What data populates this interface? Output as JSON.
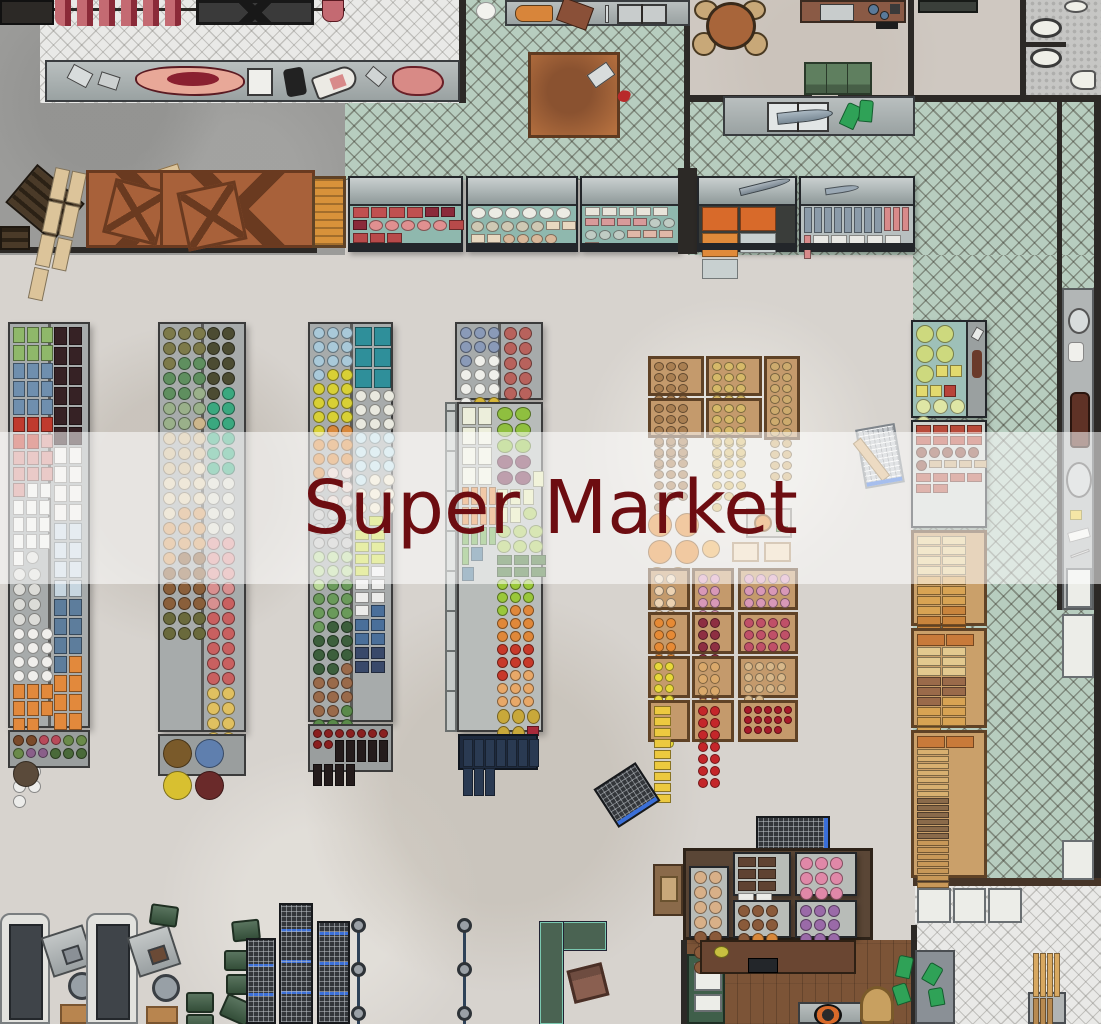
{
  "banner": {
    "title": "Super Market",
    "text_color": "#6d0d11",
    "overlay_color": "rgba(255,255,255,0.55)"
  },
  "palette": {
    "floor_main": "#d7d3ce",
    "floor_storage": "#9b9b99",
    "tile_green": "#b7cdbf",
    "tile_white": "#e9e9e7",
    "floor_breakroom": "#cfc8c1",
    "floor_bathroom": "#c6c6c4",
    "wood_floor": "#7c5437",
    "wall": "#2c2926",
    "case_interior": "#8fb8ae",
    "counter_steel": "#a8b0b0",
    "crate_wood": "#c49a6c",
    "cart_blue": "#3a6fd8",
    "service_counter_green": "#4a6352",
    "service_counter_trim": "#7ac8b0"
  },
  "fills": {
    "a1_left": [
      {
        "c": "#8fb86a",
        "n": 6,
        "s": "b",
        "w": 10,
        "h": 14
      },
      {
        "c": "#6f8fae",
        "n": 9,
        "s": "b",
        "w": 10,
        "h": 14
      },
      {
        "c": "#c03a2e",
        "n": 5,
        "s": "b",
        "w": 10,
        "h": 13
      },
      {
        "c": "#d08a86",
        "n": 8,
        "s": "b",
        "w": 10,
        "h": 12
      },
      {
        "c": "#eceae6",
        "n": 12,
        "s": "b",
        "w": 9,
        "h": 13
      },
      {
        "c": "#dcdcd8",
        "n": 9,
        "s": "r",
        "w": 11,
        "h": 11
      },
      {
        "c": "#f0efec",
        "n": 12,
        "s": "r",
        "w": 10,
        "h": 10
      },
      {
        "c": "#e2893c",
        "n": 8,
        "s": "b",
        "w": 10,
        "h": 13
      },
      {
        "c": "#ececea",
        "n": 9,
        "s": "r",
        "w": 11,
        "h": 11
      }
    ],
    "a1_right": [
      {
        "c": "#362225",
        "n": 12,
        "s": "b",
        "w": 11,
        "h": 16
      },
      {
        "c": "#ece9e4",
        "n": 8,
        "s": "b",
        "w": 11,
        "h": 15
      },
      {
        "c": "#c7d6e0",
        "n": 8,
        "s": "b",
        "w": 11,
        "h": 15
      },
      {
        "c": "#5d7d9c",
        "n": 7,
        "s": "b",
        "w": 11,
        "h": 15
      },
      {
        "c": "#e2893c",
        "n": 10,
        "s": "b",
        "w": 11,
        "h": 15
      }
    ],
    "a1_bottom": [
      {
        "c": "#7a4a2a",
        "n": 2,
        "s": "r",
        "w": 9,
        "h": 9
      },
      {
        "c": "#b84a5a",
        "n": 2,
        "s": "r",
        "w": 8,
        "h": 8
      },
      {
        "c": "#6a8a4a",
        "n": 3,
        "s": "r",
        "w": 9,
        "h": 9
      },
      {
        "c": "#8a5f8a",
        "n": 2,
        "s": "r",
        "w": 8,
        "h": 8
      },
      {
        "c": "#4a6a3a",
        "n": 3,
        "s": "r",
        "w": 9,
        "h": 9
      },
      {
        "c": "#5a4a3a",
        "n": 1,
        "s": "r",
        "w": 24,
        "h": 24
      }
    ],
    "a2_left": [
      {
        "c": "#7d7a4a",
        "n": 7,
        "s": "r",
        "w": 11,
        "h": 11
      },
      {
        "c": "#5f8f5f",
        "n": 7,
        "s": "r",
        "w": 11,
        "h": 11
      },
      {
        "c": "#9ab08a",
        "n": 6,
        "s": "r",
        "w": 11,
        "h": 11
      },
      {
        "c": "#cdb68c",
        "n": 9,
        "s": "r",
        "w": 11,
        "h": 11
      },
      {
        "c": "#dcccaa",
        "n": 8,
        "s": "r",
        "w": 11,
        "h": 11
      },
      {
        "c": "#d09a60",
        "n": 9,
        "s": "r",
        "w": 11,
        "h": 11
      },
      {
        "c": "#8a5f3a",
        "n": 11,
        "s": "r",
        "w": 11,
        "h": 11
      },
      {
        "c": "#6a6a3c",
        "n": 6,
        "s": "r",
        "w": 11,
        "h": 11
      }
    ],
    "a2_right": [
      {
        "c": "#4c4c32",
        "n": 9,
        "s": "r",
        "w": 11,
        "h": 11
      },
      {
        "c": "#3aa87f",
        "n": 11,
        "s": "r",
        "w": 11,
        "h": 11
      },
      {
        "c": "#d8d8cb",
        "n": 8,
        "s": "r",
        "w": 11,
        "h": 11
      },
      {
        "c": "#d89090",
        "n": 9,
        "s": "r",
        "w": 11,
        "h": 11
      },
      {
        "c": "#c96060",
        "n": 11,
        "s": "r",
        "w": 11,
        "h": 11
      },
      {
        "c": "#e0c060",
        "n": 11,
        "s": "r",
        "w": 11,
        "h": 11
      }
    ],
    "a2_baskets": [
      {
        "c": "#7a5a2a",
        "n": 1,
        "s": "r",
        "w": 27,
        "h": 27
      },
      {
        "c": "#5f7fae",
        "n": 1,
        "s": "r",
        "w": 27,
        "h": 27
      },
      {
        "c": "#d8c030",
        "n": 1,
        "s": "r",
        "w": 27,
        "h": 27
      },
      {
        "c": "#6a2a2a",
        "n": 1,
        "s": "r",
        "w": 27,
        "h": 27
      }
    ],
    "a3_left": [
      {
        "c": "#a9c9d9",
        "n": 10,
        "s": "r",
        "w": 10,
        "h": 10
      },
      {
        "c": "#d8d035",
        "n": 12,
        "s": "r",
        "w": 10,
        "h": 10
      },
      {
        "c": "#d8883a",
        "n": 9,
        "s": "r",
        "w": 10,
        "h": 10
      },
      {
        "c": "#e2ccc4",
        "n": 8,
        "s": "r",
        "w": 10,
        "h": 10
      },
      {
        "c": "#c2c2be",
        "n": 9,
        "s": "r",
        "w": 10,
        "h": 10
      },
      {
        "c": "#b8d898",
        "n": 7,
        "s": "r",
        "w": 10,
        "h": 10
      },
      {
        "c": "#6a9a5a",
        "n": 9,
        "s": "r",
        "w": 10,
        "h": 10
      },
      {
        "c": "#3c5f3c",
        "n": 10,
        "s": "r",
        "w": 10,
        "h": 10
      },
      {
        "c": "#9a6a4a",
        "n": 9,
        "s": "r",
        "w": 10,
        "h": 10
      },
      {
        "c": "#5a8a4a",
        "n": 7,
        "s": "r",
        "w": 10,
        "h": 10
      }
    ],
    "a3_right": [
      {
        "c": "#2f8f9a",
        "n": 6,
        "s": "b",
        "w": 15,
        "h": 17
      },
      {
        "c": "#e9e9df",
        "n": 9,
        "s": "r",
        "w": 10,
        "h": 10
      },
      {
        "c": "#bcdce4",
        "n": 10,
        "s": "r",
        "w": 10,
        "h": 10
      },
      {
        "c": "#eae2ca",
        "n": 9,
        "s": "r",
        "w": 10,
        "h": 10
      },
      {
        "c": "#c9d93c",
        "n": 8,
        "s": "b",
        "w": 12,
        "h": 8
      },
      {
        "c": "#ececea",
        "n": 6,
        "s": "b",
        "w": 12,
        "h": 9
      },
      {
        "c": "#4a6f9a",
        "n": 5,
        "s": "b",
        "w": 12,
        "h": 10
      },
      {
        "c": "#39496a",
        "n": 4,
        "s": "b",
        "w": 12,
        "h": 10
      }
    ],
    "a3_bottles": [
      {
        "c": "#8a1f1f",
        "n": 9,
        "s": "r",
        "w": 7,
        "h": 7
      },
      {
        "c": "#241c1c",
        "n": 9,
        "s": "b",
        "w": 7,
        "h": 20
      }
    ],
    "a4_cans": [
      {
        "c": "#8a9ab8",
        "n": 7,
        "s": "r",
        "w": 10,
        "h": 10
      },
      {
        "c": "#efefea",
        "n": 9,
        "s": "r",
        "w": 10,
        "h": 10
      },
      {
        "c": "#d8b83a",
        "n": 7,
        "s": "r",
        "w": 10,
        "h": 10
      },
      {
        "c": "#efefea",
        "n": 7,
        "s": "r",
        "w": 10,
        "h": 10
      },
      {
        "c": "#b84a3a",
        "n": 8,
        "s": "r",
        "w": 10,
        "h": 10
      }
    ],
    "a4_cans_right": [
      {
        "c": "#b8625c",
        "n": 14,
        "s": "r",
        "w": 11,
        "h": 11
      }
    ],
    "a4_packs": [
      {
        "c": "#eceedb",
        "n": 8,
        "s": "b",
        "w": 12,
        "h": 16
      },
      {
        "c": "#e0853a",
        "n": 8,
        "s": "b",
        "w": 5,
        "h": 16
      },
      {
        "c": "#6aa84a",
        "n": 5,
        "s": "b",
        "w": 5,
        "h": 16
      },
      {
        "c": "#3a6a8a",
        "n": 2,
        "s": "b",
        "w": 10,
        "h": 12
      }
    ],
    "a4_veg": [
      {
        "c": "#8fbf3f",
        "n": 6,
        "s": "r",
        "w": 14,
        "h": 12
      },
      {
        "c": "#6f2a4a",
        "n": 4,
        "s": "r",
        "w": 14,
        "h": 12
      },
      {
        "c": "#dfe4ad",
        "n": 6,
        "s": "b",
        "w": 9,
        "h": 14
      },
      {
        "c": "#a8c85a",
        "n": 7,
        "s": "r",
        "w": 12,
        "h": 11
      },
      {
        "c": "#3a6a2a",
        "n": 6,
        "s": "b",
        "w": 13,
        "h": 8
      },
      {
        "c": "#9ac83a",
        "n": 7,
        "s": "r",
        "w": 9,
        "h": 9
      },
      {
        "c": "#e0883a",
        "n": 8,
        "s": "r",
        "w": 9,
        "h": 9
      },
      {
        "c": "#c8392a",
        "n": 7,
        "s": "r",
        "w": 9,
        "h": 9
      },
      {
        "c": "#e8a868",
        "n": 8,
        "s": "r",
        "w": 9,
        "h": 9
      },
      {
        "c": "#c8a83a",
        "n": 5,
        "s": "r",
        "w": 11,
        "h": 13
      },
      {
        "c": "#a82a3a",
        "n": 6,
        "s": "b",
        "w": 10,
        "h": 8
      }
    ],
    "a4_mats": [
      {
        "c": "#2a3a52",
        "n": 10,
        "s": "b",
        "w": 8,
        "h": 26
      }
    ],
    "potato_brown": [
      {
        "c": "#a97f52",
        "n": 28,
        "s": "r",
        "w": 8,
        "h": 7
      }
    ],
    "potato_yellow": [
      {
        "c": "#d6b969",
        "n": 28,
        "s": "r",
        "w": 8,
        "h": 7
      }
    ],
    "potato_tan": [
      {
        "c": "#cdab6e",
        "n": 22,
        "s": "r",
        "w": 8,
        "h": 7
      }
    ],
    "f_peach": [
      {
        "c": "#ecd2b2",
        "n": 14,
        "s": "r",
        "w": 8,
        "h": 8
      }
    ],
    "f_pink": [
      {
        "c": "#d898b8",
        "n": 12,
        "s": "r",
        "w": 8,
        "h": 8
      }
    ],
    "f_orange": [
      {
        "c": "#e68a35",
        "n": 14,
        "s": "r",
        "w": 8,
        "h": 8
      }
    ],
    "f_beet": [
      {
        "c": "#8e2f42",
        "n": 14,
        "s": "r",
        "w": 8,
        "h": 8
      }
    ],
    "f_rose": [
      {
        "c": "#c05068",
        "n": 12,
        "s": "r",
        "w": 8,
        "h": 8
      }
    ],
    "f_lemon": [
      {
        "c": "#e8d83a",
        "n": 16,
        "s": "r",
        "w": 7,
        "h": 7
      }
    ],
    "f_apricot": [
      {
        "c": "#daa96b",
        "n": 14,
        "s": "r",
        "w": 8,
        "h": 8
      }
    ],
    "f_tan": [
      {
        "c": "#d8b88a",
        "n": 14,
        "s": "r",
        "w": 7,
        "h": 7
      }
    ],
    "f_banana": [
      {
        "c": "#ecc93f",
        "n": 9,
        "s": "b",
        "w": 15,
        "h": 7
      }
    ],
    "f_apple": [
      {
        "c": "#c4262a",
        "n": 14,
        "s": "r",
        "w": 8,
        "h": 8
      }
    ],
    "f_cherry": [
      {
        "c": "#a81a2a",
        "n": 14,
        "s": "r",
        "w": 6,
        "h": 6
      }
    ],
    "pumpkins": [
      {
        "c": "#e0882f",
        "n": 4,
        "s": "r",
        "w": 22,
        "h": 22
      },
      {
        "c": "#e8a84f",
        "n": 3,
        "s": "r",
        "w": 16,
        "h": 16
      }
    ],
    "cheese": [
      {
        "c": "#cdd97e",
        "n": 5,
        "s": "r",
        "w": 16,
        "h": 16
      },
      {
        "c": "#e3da6e",
        "n": 4,
        "s": "b",
        "w": 10,
        "h": 10
      },
      {
        "c": "#b8433a",
        "n": 1,
        "s": "b",
        "w": 10,
        "h": 10
      },
      {
        "c": "#dfe6a5",
        "n": 4,
        "s": "r",
        "w": 13,
        "h": 13
      }
    ],
    "deli_cold": [
      {
        "c": "#b84a3a",
        "n": 8,
        "s": "b",
        "w": 13,
        "h": 7
      },
      {
        "c": "#8a4a3a",
        "n": 6,
        "s": "r",
        "w": 9,
        "h": 9
      },
      {
        "c": "#c8a87a",
        "n": 4,
        "s": "b",
        "w": 11,
        "h": 6
      },
      {
        "c": "#b85a4a",
        "n": 6,
        "s": "b",
        "w": 13,
        "h": 7
      }
    ],
    "bread_a": [
      {
        "c": "#e3c98f",
        "n": 8,
        "s": "b",
        "w": 22,
        "h": 7
      },
      {
        "c": "#d8a353",
        "n": 7,
        "s": "b",
        "w": 22,
        "h": 7
      },
      {
        "c": "#c9843c",
        "n": 6,
        "s": "b",
        "w": 22,
        "h": 7
      }
    ],
    "bread_b": [
      {
        "c": "#c87a3a",
        "n": 2,
        "s": "b",
        "w": 26,
        "h": 10
      },
      {
        "c": "#e3c98f",
        "n": 6,
        "s": "b",
        "w": 22,
        "h": 7
      },
      {
        "c": "#9a6a4a",
        "n": 5,
        "s": "b",
        "w": 22,
        "h": 7
      },
      {
        "c": "#d8a353",
        "n": 6,
        "s": "b",
        "w": 22,
        "h": 7
      }
    ],
    "bread_c": [
      {
        "c": "#c87a3a",
        "n": 2,
        "s": "b",
        "w": 26,
        "h": 10
      },
      {
        "c": "#d8b070",
        "n": 7,
        "s": "b",
        "w": 30,
        "h": 4
      },
      {
        "c": "#8a6a4a",
        "n": 6,
        "s": "b",
        "w": 30,
        "h": 4
      },
      {
        "c": "#c89858",
        "n": 7,
        "s": "b",
        "w": 30,
        "h": 4
      }
    ],
    "case_meat": [
      {
        "c": "#c05050",
        "n": 4,
        "s": "b",
        "w": 14,
        "h": 9
      },
      {
        "c": "#8a2a3a",
        "n": 3,
        "s": "b",
        "w": 12,
        "h": 8
      },
      {
        "c": "#e09090",
        "n": 5,
        "s": "r",
        "w": 12,
        "h": 9
      },
      {
        "c": "#b84a4a",
        "n": 4,
        "s": "b",
        "w": 13,
        "h": 8
      }
    ],
    "case_poultry": [
      {
        "c": "#ecece4",
        "n": 6,
        "s": "r",
        "w": 13,
        "h": 10
      },
      {
        "c": "#cfc9b4",
        "n": 5,
        "s": "r",
        "w": 11,
        "h": 9
      },
      {
        "c": "#e8d8c0",
        "n": 4,
        "s": "b",
        "w": 12,
        "h": 7
      },
      {
        "c": "#d8b89a",
        "n": 4,
        "s": "r",
        "w": 10,
        "h": 8
      }
    ],
    "case_fish": [
      {
        "c": "#e8e4da",
        "n": 5,
        "s": "b",
        "w": 13,
        "h": 7
      },
      {
        "c": "#d89a9a",
        "n": 4,
        "s": "b",
        "w": 12,
        "h": 6
      },
      {
        "c": "#c0ccc4",
        "n": 5,
        "s": "r",
        "w": 10,
        "h": 8
      },
      {
        "c": "#e0b8a8",
        "n": 4,
        "s": "b",
        "w": 12,
        "h": 6
      }
    ],
    "case_roe": [
      {
        "c": "#d86a2a",
        "n": 2,
        "s": "b",
        "w": 34,
        "h": 22
      },
      {
        "c": "#e08a3a",
        "n": 1,
        "s": "b",
        "w": 34,
        "h": 22
      },
      {
        "c": "#c8d0d0",
        "n": 2,
        "s": "b",
        "w": 34,
        "h": 18
      }
    ],
    "case_ice_fish": [
      {
        "c": "#8a9aa8",
        "n": 8,
        "s": "b",
        "w": 6,
        "h": 24
      },
      {
        "c": "#d88a8a",
        "n": 4,
        "s": "b",
        "w": 5,
        "h": 22
      },
      {
        "c": "#e8e8e4",
        "n": 5,
        "s": "b",
        "w": 14,
        "h": 7
      }
    ],
    "tray_cookies": [
      {
        "c": "#d8b088",
        "n": 8,
        "s": "r",
        "w": 11,
        "h": 11
      },
      {
        "c": "#8a5a3a",
        "n": 5,
        "s": "r",
        "w": 11,
        "h": 11
      }
    ],
    "tray_eclairs": [
      {
        "c": "#5f4232",
        "n": 6,
        "s": "b",
        "w": 16,
        "h": 8
      },
      {
        "c": "#ecece8",
        "n": 5,
        "s": "b",
        "w": 14,
        "h": 7
      }
    ],
    "tray_cupcakes": [
      {
        "c": "#e088a8",
        "n": 10,
        "s": "r",
        "w": 11,
        "h": 11
      }
    ],
    "tray_donuts": [
      {
        "c": "#8a5a3a",
        "n": 7,
        "s": "r",
        "w": 10,
        "h": 10
      },
      {
        "c": "#d8883a",
        "n": 3,
        "s": "r",
        "w": 10,
        "h": 10
      },
      {
        "c": "#e8d060",
        "n": 3,
        "s": "r",
        "w": 10,
        "h": 10
      }
    ],
    "tray_purple": [
      {
        "c": "#9a6aa8",
        "n": 9,
        "s": "r",
        "w": 10,
        "h": 10
      }
    ],
    "storage_planks": [
      {
        "c": "#dcc49a",
        "n": 7,
        "s": "b",
        "w": 13,
        "h": 30
      }
    ],
    "baguette_oven": [
      {
        "c": "#d8a860",
        "n": 4,
        "s": "b",
        "w": 4,
        "h": 42
      },
      {
        "c": "#b88a50",
        "n": 3,
        "s": "b",
        "w": 4,
        "h": 42
      }
    ]
  }
}
